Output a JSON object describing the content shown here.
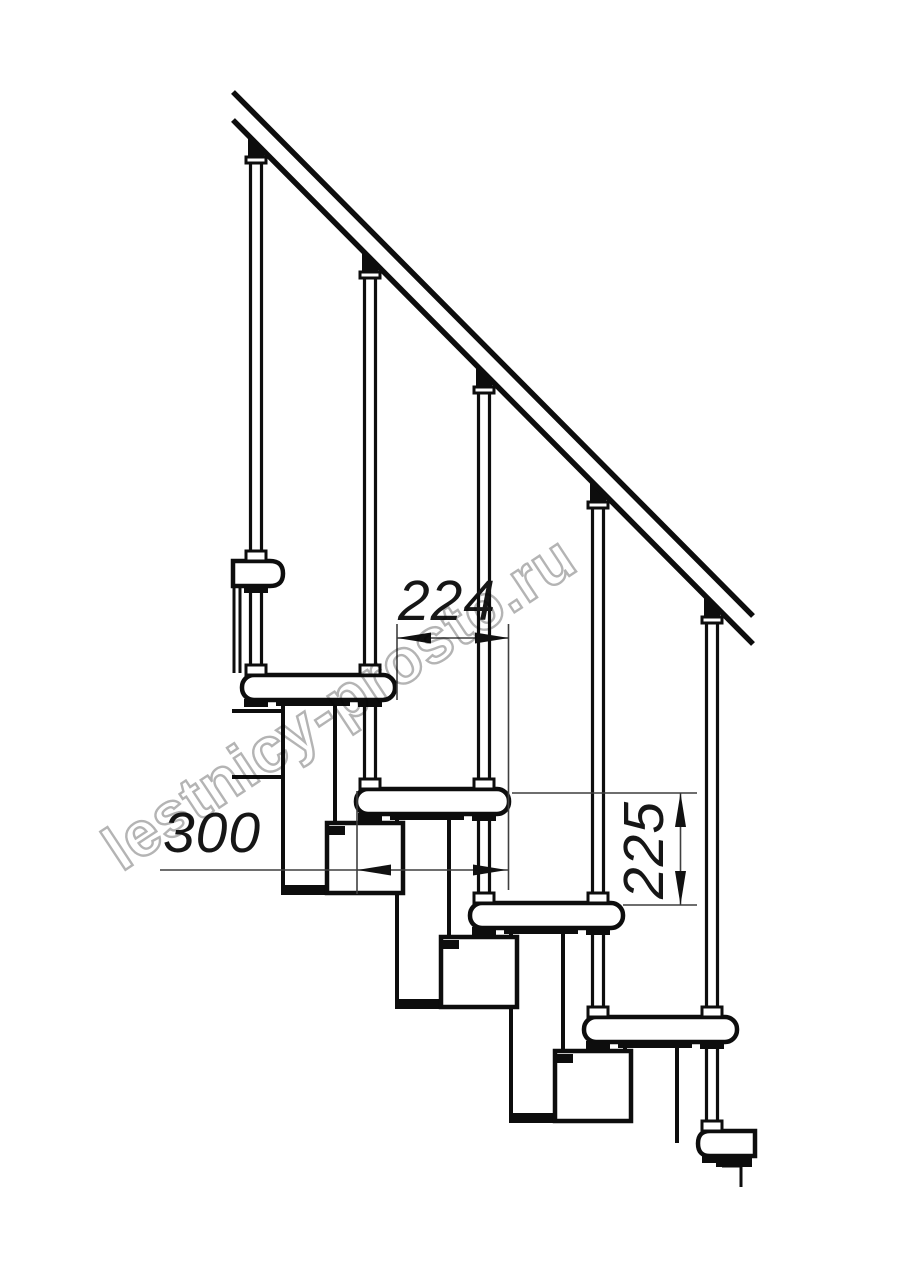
{
  "diagram": {
    "type": "technical-drawing",
    "subject": "modular staircase side elevation",
    "background_color": "#ffffff",
    "ink_color": "#0d0d0d",
    "dim_line_color": "#3f3f3f",
    "dimensions": {
      "run": {
        "label": "224",
        "orientation": "horizontal",
        "meaning": "step run between tread edges"
      },
      "depth": {
        "label": "300",
        "orientation": "horizontal",
        "meaning": "tread depth"
      },
      "rise": {
        "label": "225",
        "orientation": "vertical",
        "meaning": "step rise between tread tops"
      }
    },
    "watermark": {
      "text": "lestnicy-prosto.ru",
      "color": "#b4b4b4"
    }
  }
}
